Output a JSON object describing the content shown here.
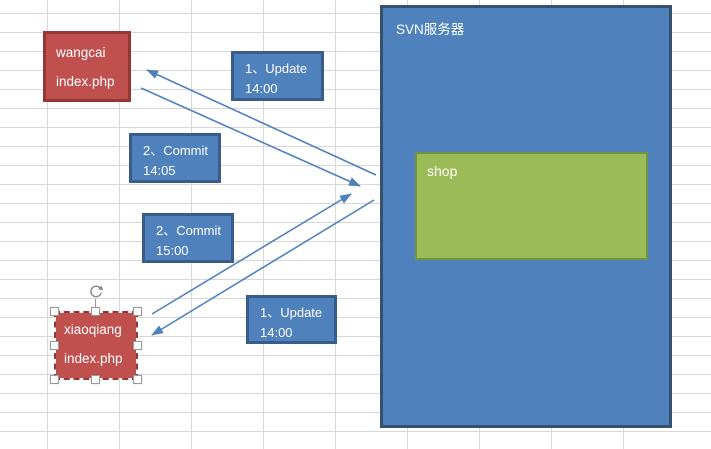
{
  "colors": {
    "accent_blue": "#4f81bd",
    "accent_blue_border": "#385d8a",
    "accent_blue_dark": "#36506e",
    "accent_red": "#c0504d",
    "accent_red_dark": "#953735",
    "accent_green": "#9bbb59",
    "accent_green_dark": "#77933c",
    "connector": "#4f81bd",
    "grid": "#d8d8d8"
  },
  "diagram": {
    "server": {
      "label": "SVN服务器"
    },
    "shop": {
      "label": "shop"
    },
    "wangcai": {
      "line1": "wangcai",
      "line2": "index.php"
    },
    "xiaoqiang": {
      "line1": "xiaoqiang",
      "line2": "index.php"
    },
    "step_labels": {
      "update_wangcai": {
        "line1": "1、Update",
        "line2": "14:00"
      },
      "commit_wangcai": {
        "line1": "2、Commit",
        "line2": "14:05"
      },
      "commit_xiaoqiang": {
        "line1": "2、Commit",
        "line2": "15:00"
      },
      "update_xiaoqiang": {
        "line1": "1、Update",
        "line2": "14:00"
      }
    },
    "edges": [
      {
        "name": "edge-update-to-wangcai",
        "x1": 376,
        "y1": 175,
        "x2": 147,
        "y2": 70
      },
      {
        "name": "edge-commit-from-wangcai",
        "x1": 141,
        "y1": 88,
        "x2": 360,
        "y2": 186
      },
      {
        "name": "edge-commit-from-xiaoqiang",
        "x1": 152,
        "y1": 314,
        "x2": 351,
        "y2": 194
      },
      {
        "name": "edge-update-to-xiaoqiang",
        "x1": 374,
        "y1": 200,
        "x2": 152,
        "y2": 335
      }
    ]
  }
}
